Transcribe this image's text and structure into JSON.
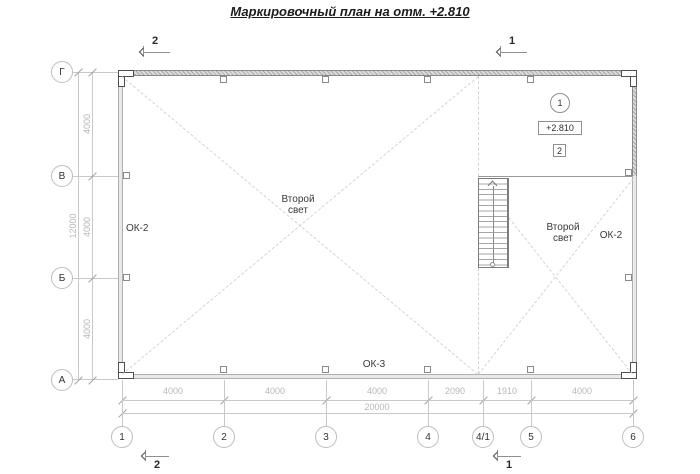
{
  "title": "Маркировочный план на отм. +2.810",
  "axes": {
    "left": [
      "Г",
      "В",
      "Б",
      "А"
    ],
    "bottom": [
      "1",
      "2",
      "3",
      "4",
      "4/1",
      "5",
      "6"
    ]
  },
  "dimensions": {
    "left_segments": [
      "4000",
      "4000",
      "4000"
    ],
    "left_total": "12000",
    "bottom_segments": [
      "4000",
      "4000",
      "4000",
      "2090",
      "1910",
      "4000"
    ],
    "bottom_total": "20000"
  },
  "sections": {
    "top_left": "2",
    "top_right": "1",
    "bottom_left": "2",
    "bottom_right": "1"
  },
  "platform": {
    "position_mark": "1",
    "elevation": "+2.810",
    "detail_mark": "2"
  },
  "labels": {
    "window_left": "ОК-2",
    "window_right": "ОК-2",
    "window_bottom": "ОК-3",
    "second_light": {
      "line1": "Второй",
      "line2": "свет"
    }
  },
  "icons": {
    "section_cut_arrow": "chevron-left",
    "stair_direction_arrow": "chevron-up"
  },
  "colors": {
    "line_light": "#c9c9c9",
    "dim_text": "#b7b7b7",
    "dark_text": "#2b2b2b",
    "wall_fill": "#e9e9e9",
    "wall_cut_fill": "#dcdcdc",
    "dashed_line": "#d3d3d3"
  }
}
